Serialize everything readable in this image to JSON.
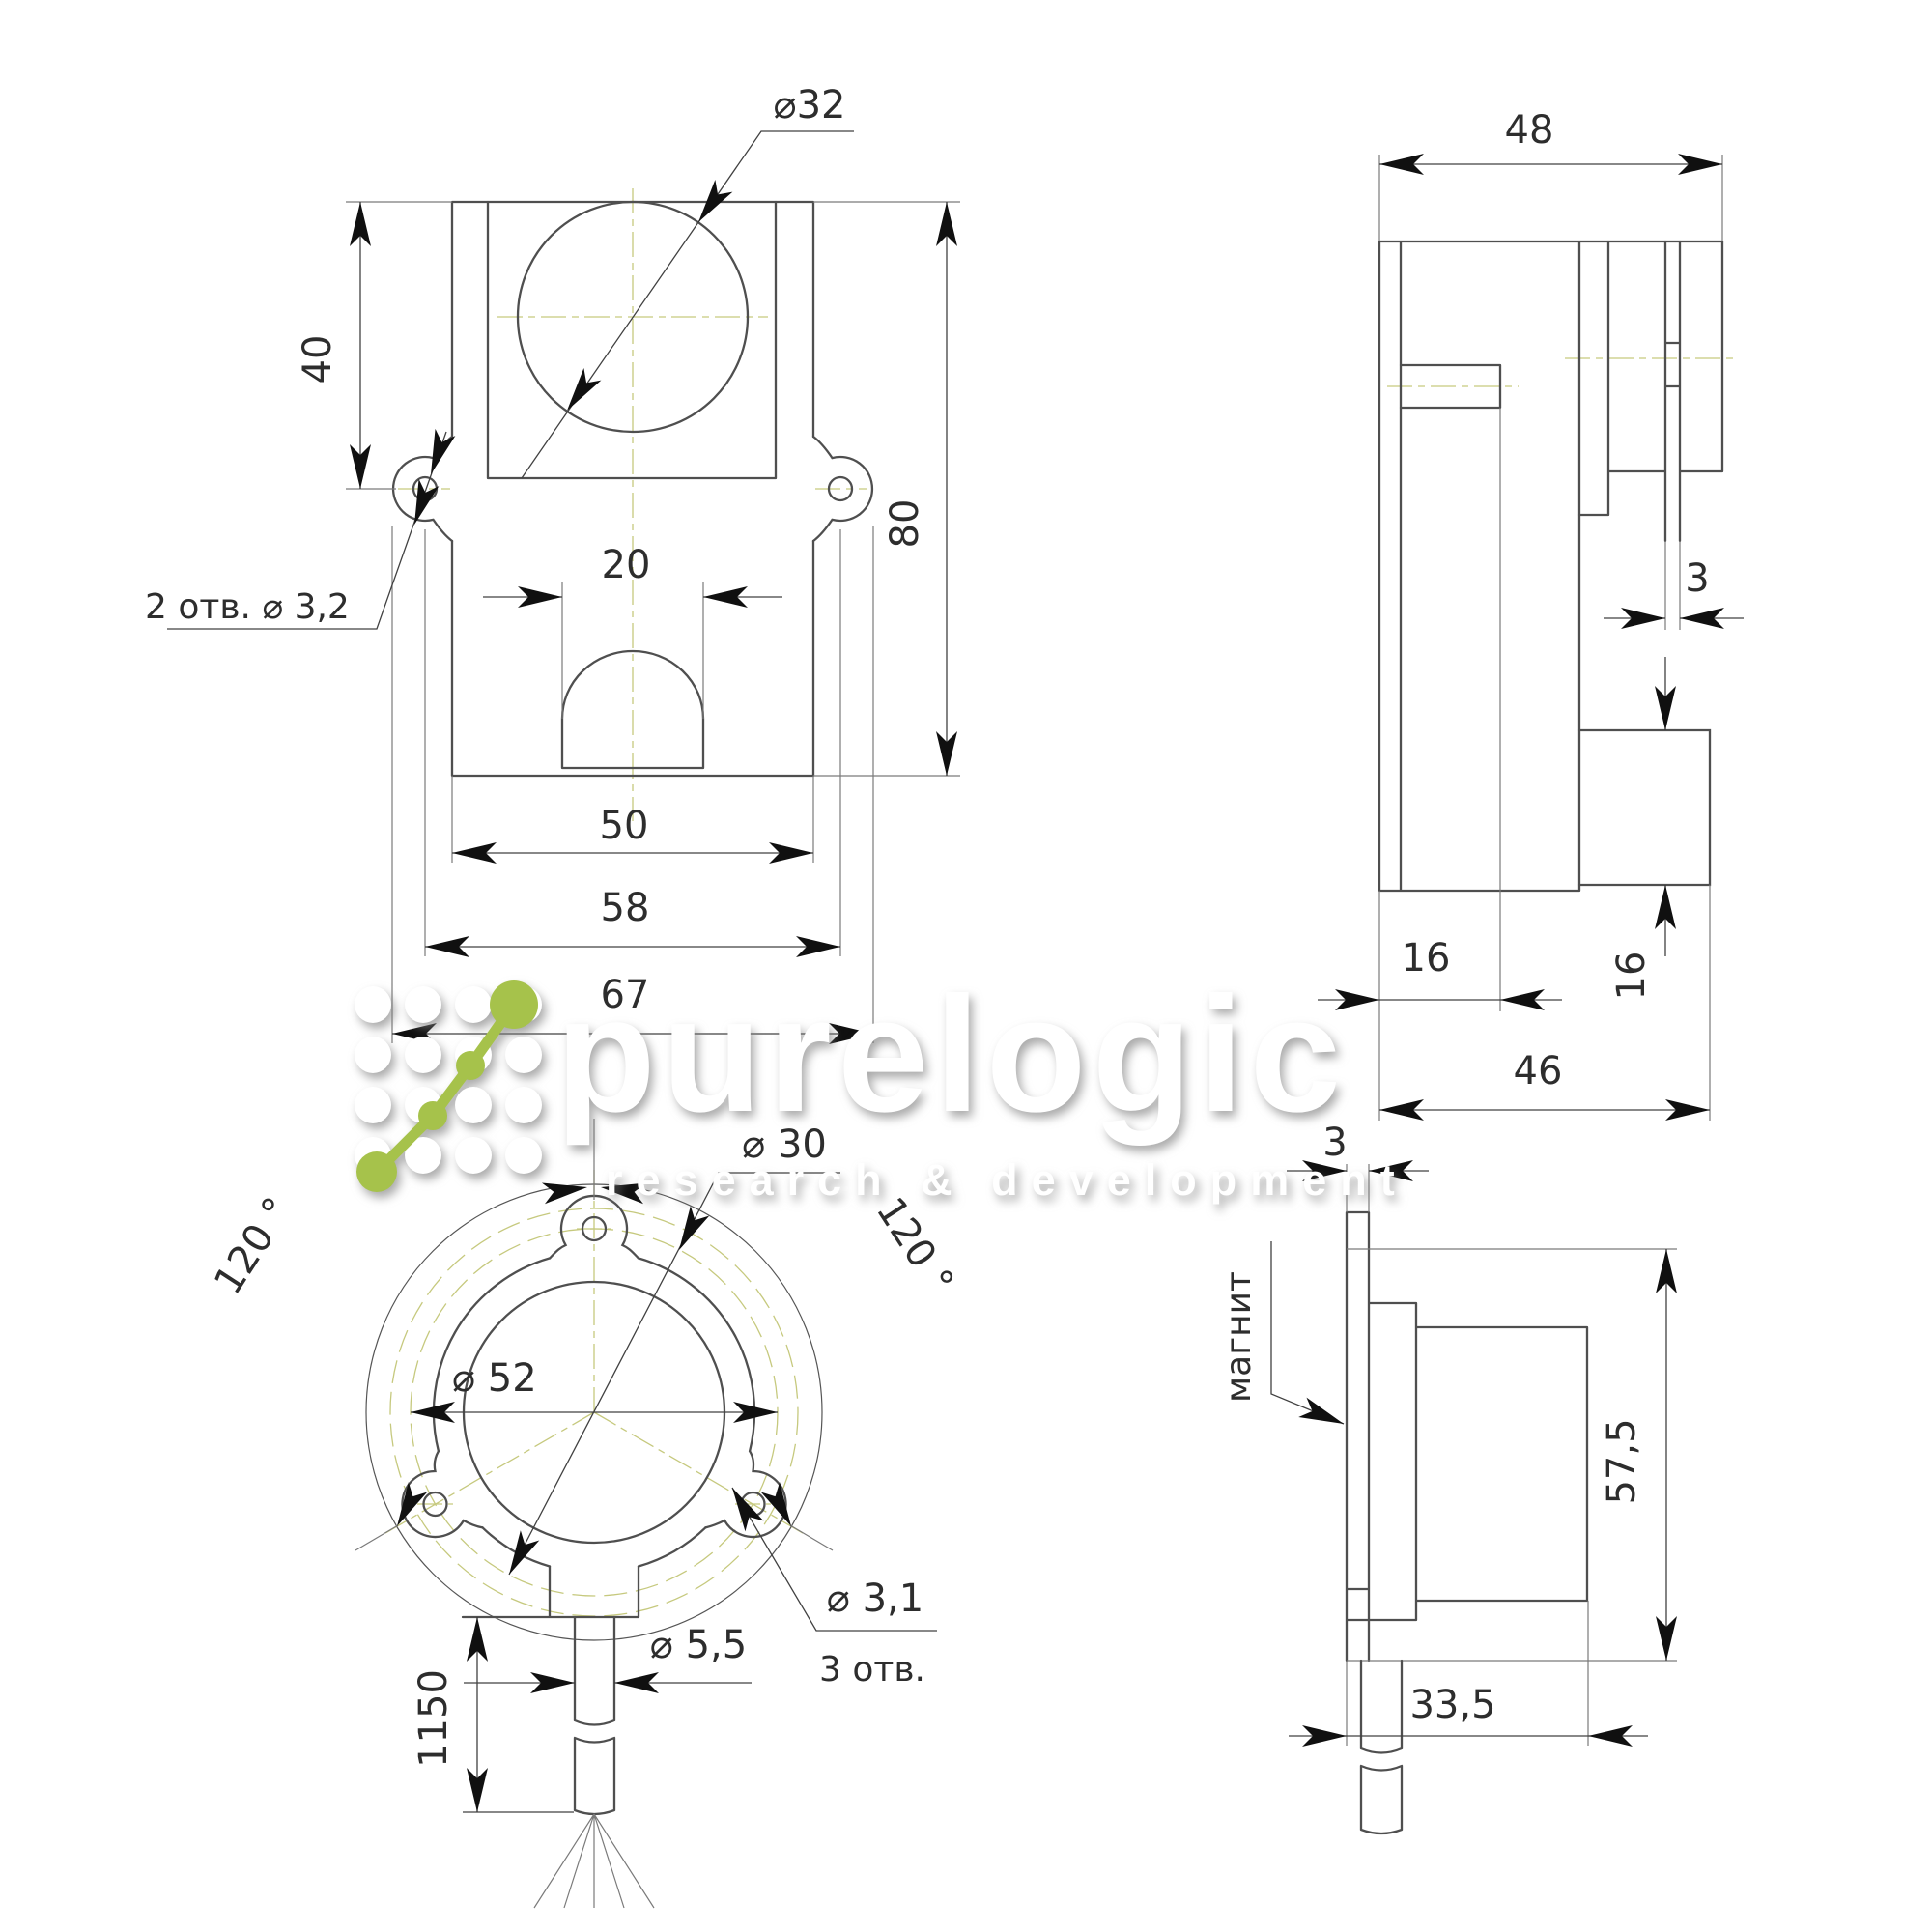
{
  "watermark": {
    "brand": "purelogic",
    "tagline": "research & development",
    "accent_color": "#a6c24b",
    "text_color": "#ffffff"
  },
  "colors": {
    "line": "#4f4f4f",
    "dimension": "#414141",
    "centerline": "#c6c97e",
    "background": "#ffffff"
  },
  "views": {
    "front": {
      "d40": "40",
      "d80": "80",
      "d20": "20",
      "d50": "50",
      "d58": "58",
      "d67": "67",
      "dia32": "⌀32",
      "holes2": "2 отв.   ⌀ 3,2"
    },
    "side_top": {
      "d48": "48",
      "d3": "3",
      "d16_vert": "16",
      "d16_horiz": "16",
      "d46": "46"
    },
    "flange": {
      "dia30": "⌀ 30",
      "dia52": "⌀ 52",
      "angle_left": "120 °",
      "angle_right": "120 °",
      "dia31": "⌀ 3,1",
      "holes3": "3 отв.",
      "dia55": "⌀ 5,5",
      "d1150": "1150"
    },
    "side_bottom": {
      "d3": "3",
      "magnet": "магнит",
      "d575": "57,5",
      "d335": "33,5"
    }
  }
}
